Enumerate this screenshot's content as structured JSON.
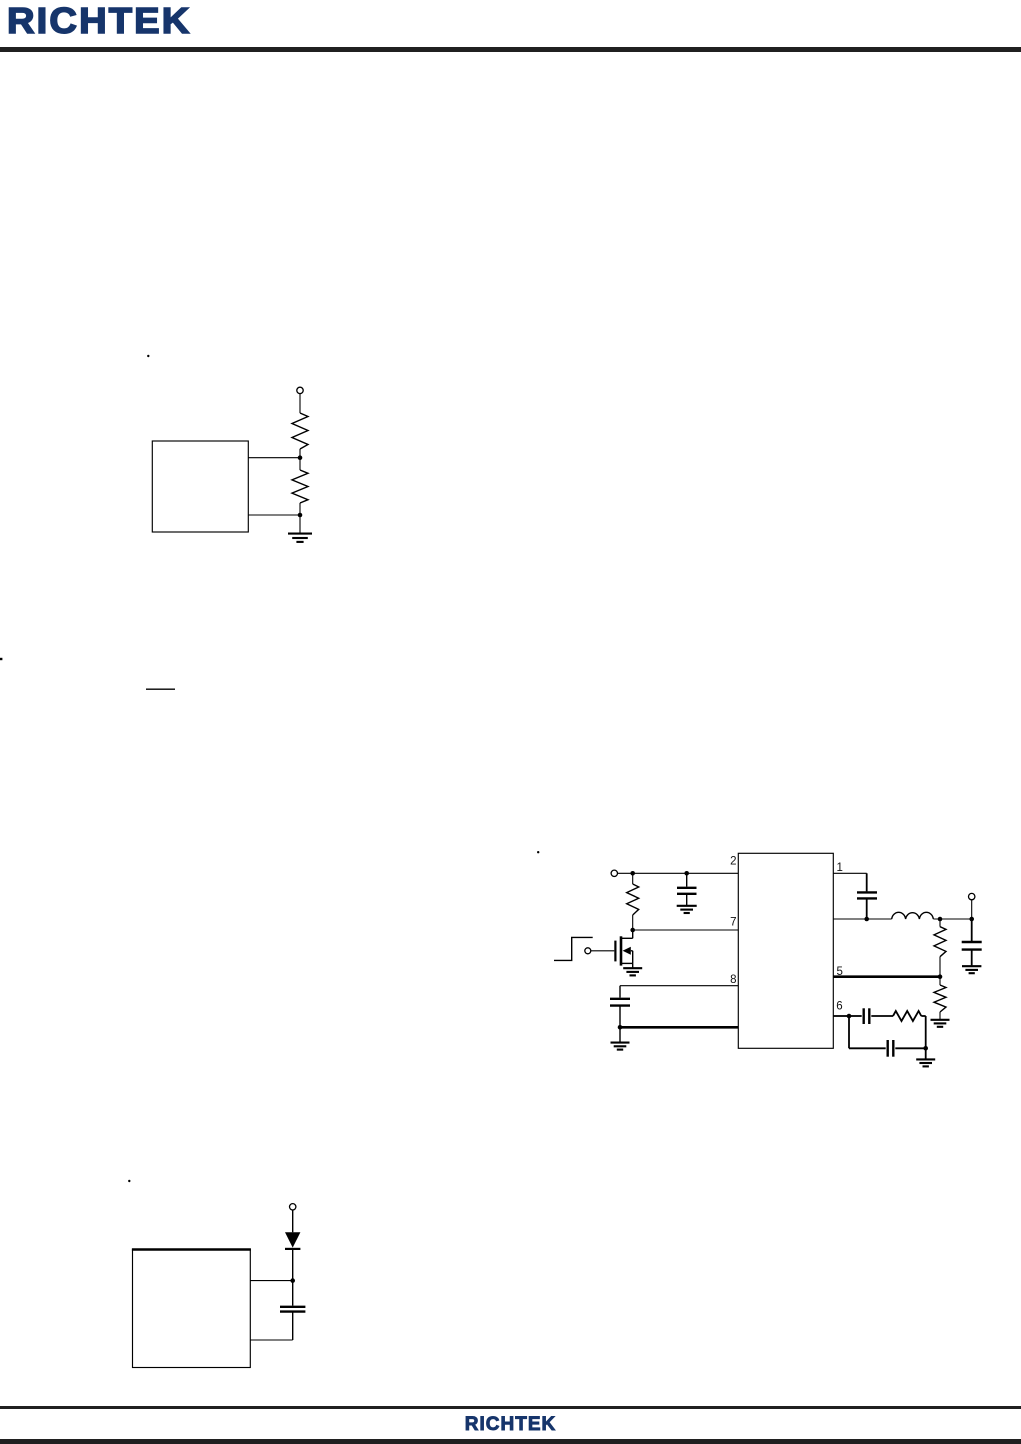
{
  "page": {
    "width": 1021,
    "height": 1444,
    "background": "#ffffff"
  },
  "brand": {
    "color": "#16356b",
    "rule_color": "#202020",
    "line_color": "#000000"
  },
  "header": {
    "logo_text": "RICHTEK"
  },
  "footer": {
    "logo_text": "RICHTEK"
  },
  "main_circuit": {
    "pins": {
      "p1": "1",
      "p2": "2",
      "p5": "5",
      "p6": "6",
      "p7": "7",
      "p8": "8"
    }
  }
}
